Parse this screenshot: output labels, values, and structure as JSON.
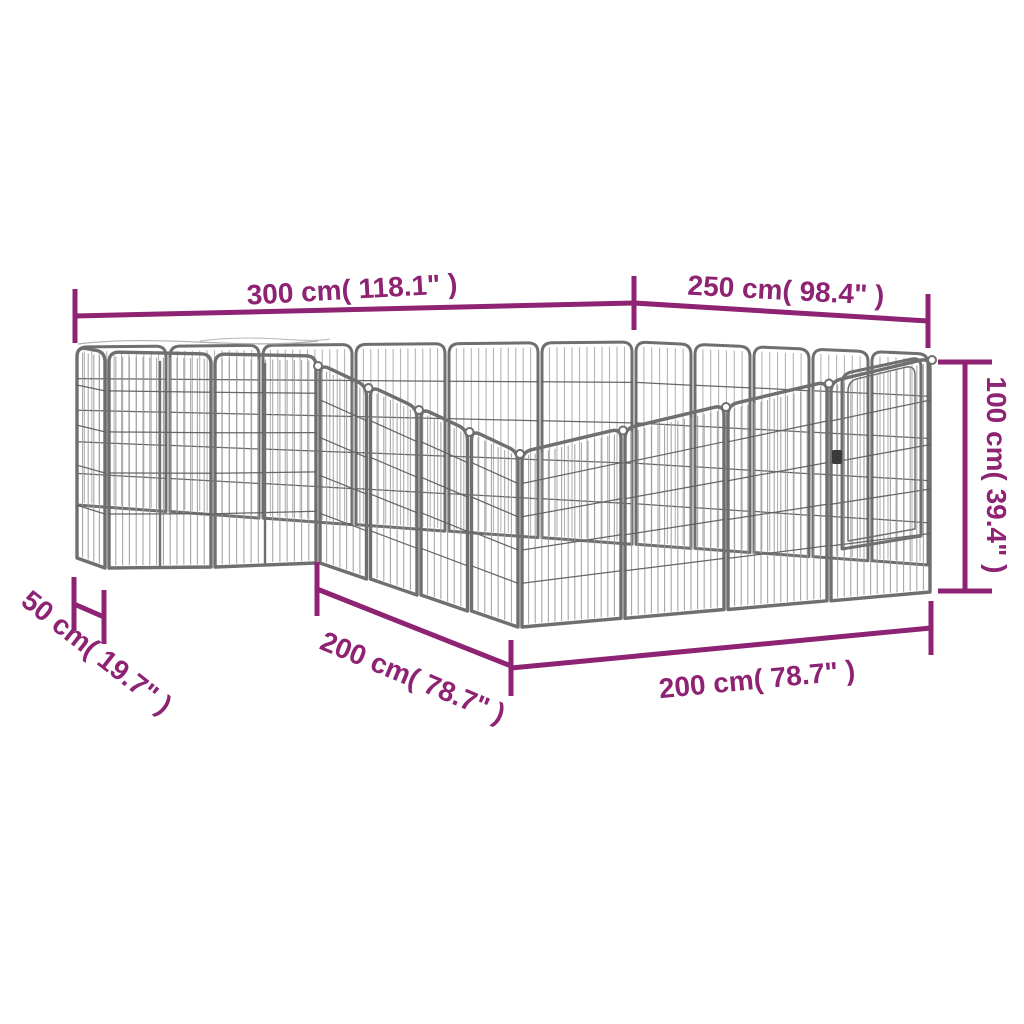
{
  "diagram": {
    "title": "dog playpen dimension diagram",
    "accent_color": "#8E2273",
    "frame_color": "#6f6f6f",
    "dimensions": {
      "back_left": "300 cm( 118.1\" )",
      "back_right": "250 cm( 98.4\" )",
      "height": "100 cm( 39.4\" )",
      "side_depth": "50 cm( 19.7\" )",
      "front_left": "200 cm( 78.7\" )",
      "front_bottom": "200 cm( 78.7\" )"
    }
  }
}
